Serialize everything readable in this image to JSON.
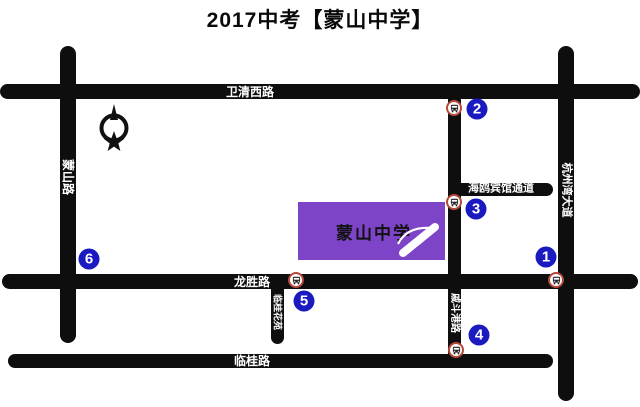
{
  "title": "2017中考【蒙山中学】",
  "map": {
    "roads": {
      "weiqing": "卫清西路",
      "mengshan": "蒙山路",
      "hangzhouwan": "杭州湾大道",
      "haiou_passage": "海鸥宾馆通道",
      "longsheng": "龙胜路",
      "lingui": "临桂路",
      "qidougang": "戚斗港路",
      "linguihuayuan": "临桂花苑"
    },
    "school": {
      "name": "蒙山中学",
      "fill_color": "#7d44c7"
    },
    "compass": {
      "letter": "N"
    },
    "markers": [
      {
        "label": "1"
      },
      {
        "label": "2"
      },
      {
        "label": "3"
      },
      {
        "label": "4"
      },
      {
        "label": "5"
      },
      {
        "label": "6"
      }
    ],
    "legend_colors": {
      "road": "#0e0e0e",
      "marker_blue": "#1a1ac0",
      "bus_ring_red": "#b5483a",
      "school_purple": "#7d44c7"
    }
  }
}
